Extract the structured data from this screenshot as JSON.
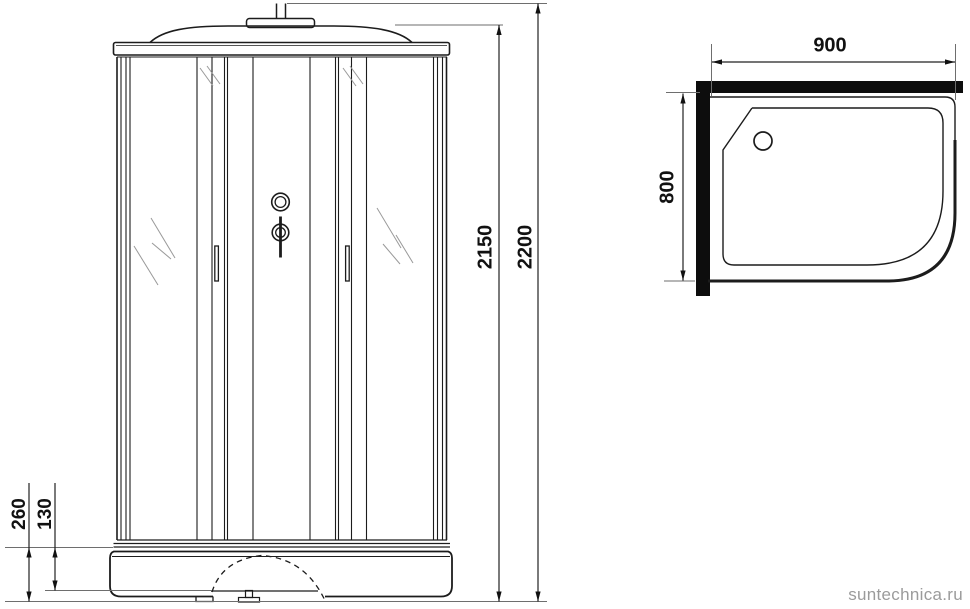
{
  "dimensions": {
    "overall_height_mm": "2200",
    "cabin_height_mm": "2150",
    "tray_height_mm": "260",
    "tray_step_mm": "130",
    "tray_width_mm": "900",
    "tray_depth_mm": "800"
  },
  "watermark": {
    "text": "suntechnica.ru",
    "color": "#9b9b9b"
  },
  "colors": {
    "line": "#1c1c1c",
    "dim_line": "#222222",
    "reference_line": "#6e6e6e",
    "glass_hatch": "#999999",
    "wall_fill": "#0d0d0d"
  }
}
